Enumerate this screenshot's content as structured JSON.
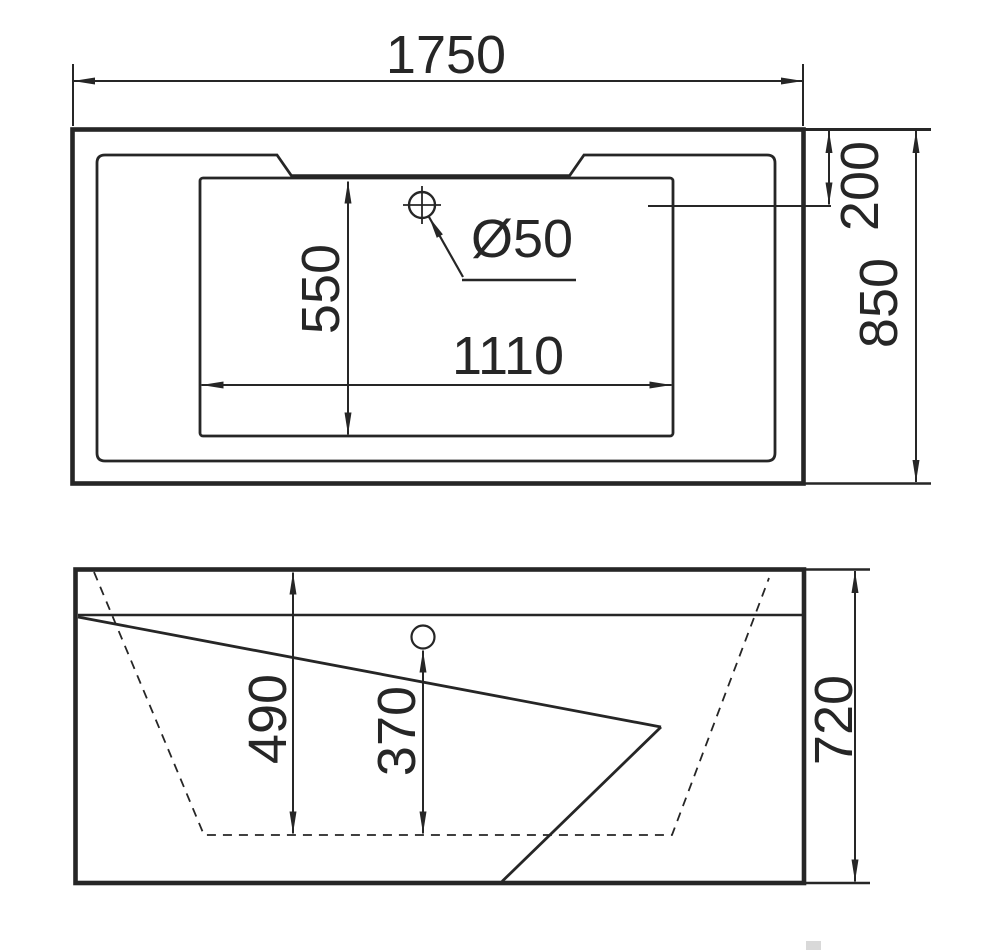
{
  "drawing": {
    "background_color": "#ffffff",
    "ink_color": "#262626",
    "top_view": {
      "dim_overall_width": "1750",
      "dim_overall_depth": "850",
      "dim_rim_to_drain_offset": "200",
      "dim_basin_length": "1110",
      "dim_basin_width": "550",
      "label_drain_diameter": "Ø50"
    },
    "side_view": {
      "dim_overall_height": "720",
      "dim_inner_depth": "490",
      "dim_drain_height": "370"
    }
  }
}
